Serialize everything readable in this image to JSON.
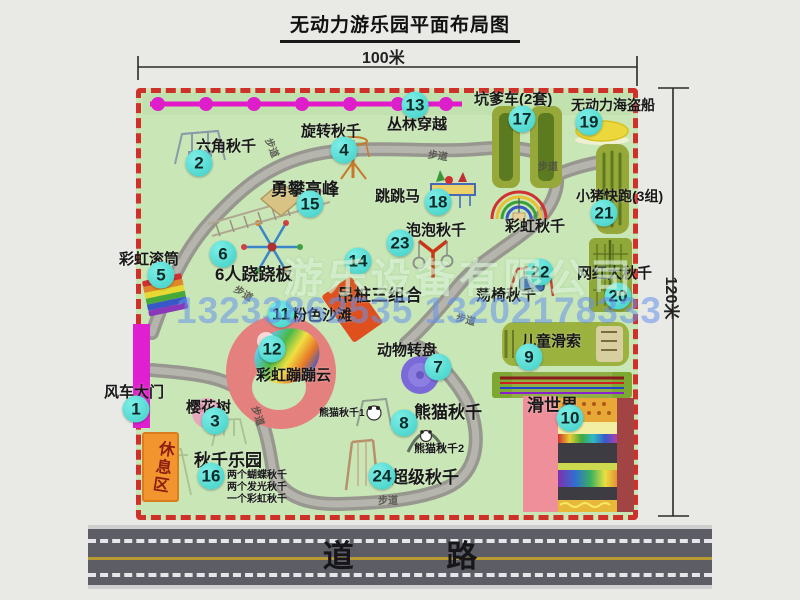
{
  "title": "无动力游乐园平面布局图",
  "dims": {
    "width": "100米",
    "height": "120米"
  },
  "road": {
    "label": "道 路"
  },
  "watermark": {
    "company": "游乐设备有限公司",
    "phone": "13233862535 13202178333"
  },
  "walkway_label": "步道",
  "areas": {
    "rest": {
      "name": "休息区"
    },
    "rainbow_swing": {
      "name": "彩虹秋千"
    }
  },
  "items": {
    "gate": {
      "num": "1",
      "name": "风车大门"
    },
    "hex_swing": {
      "num": "2",
      "name": "六角秋千"
    },
    "cherry": {
      "num": "3",
      "name": "樱花树"
    },
    "rotate_swing": {
      "num": "4",
      "name": "旋转秋千"
    },
    "roller": {
      "num": "5",
      "name": "彩虹滚筒"
    },
    "seesaw": {
      "num": "6",
      "name": "6人跷跷板"
    },
    "turntable": {
      "num": "7",
      "name": "动物转盘"
    },
    "panda": {
      "num": "8",
      "name": "熊猫秋千",
      "sub1": "熊猫秋千1",
      "sub2": "熊猫秋千2"
    },
    "zipline": {
      "num": "9",
      "name": "儿童滑索"
    },
    "slide_world": {
      "num": "10",
      "name": "滑世界"
    },
    "pink_beach": {
      "num": "11",
      "name": "粉色沙滩"
    },
    "cloud": {
      "num": "12",
      "name": "彩虹蹦蹦云"
    },
    "jungle": {
      "num": "13",
      "name": "丛林穿越"
    },
    "piles": {
      "num": "14",
      "name": "吊桩三组合"
    },
    "peak": {
      "num": "15",
      "name": "勇攀高峰"
    },
    "swing_park": {
      "num": "16",
      "name": "秋千乐园",
      "notes": [
        "两个蝴蝶秋千",
        "两个发光秋千",
        "一个彩虹秋千"
      ]
    },
    "pit_car": {
      "num": "17",
      "name": "坑爹车(2套)"
    },
    "horse": {
      "num": "18",
      "name": "跳跳马"
    },
    "pirate": {
      "num": "19",
      "name": "无动力海盗船"
    },
    "big_swing": {
      "num": "20",
      "name": "网红大秋千"
    },
    "pig_run": {
      "num": "21",
      "name": "小猪快跑(3组)"
    },
    "chair_swing": {
      "num": "22",
      "name": "荡椅秋千"
    },
    "bubble": {
      "num": "23",
      "name": "泡泡秋千"
    },
    "super_swing": {
      "num": "24",
      "name": "超级秋千"
    }
  }
}
